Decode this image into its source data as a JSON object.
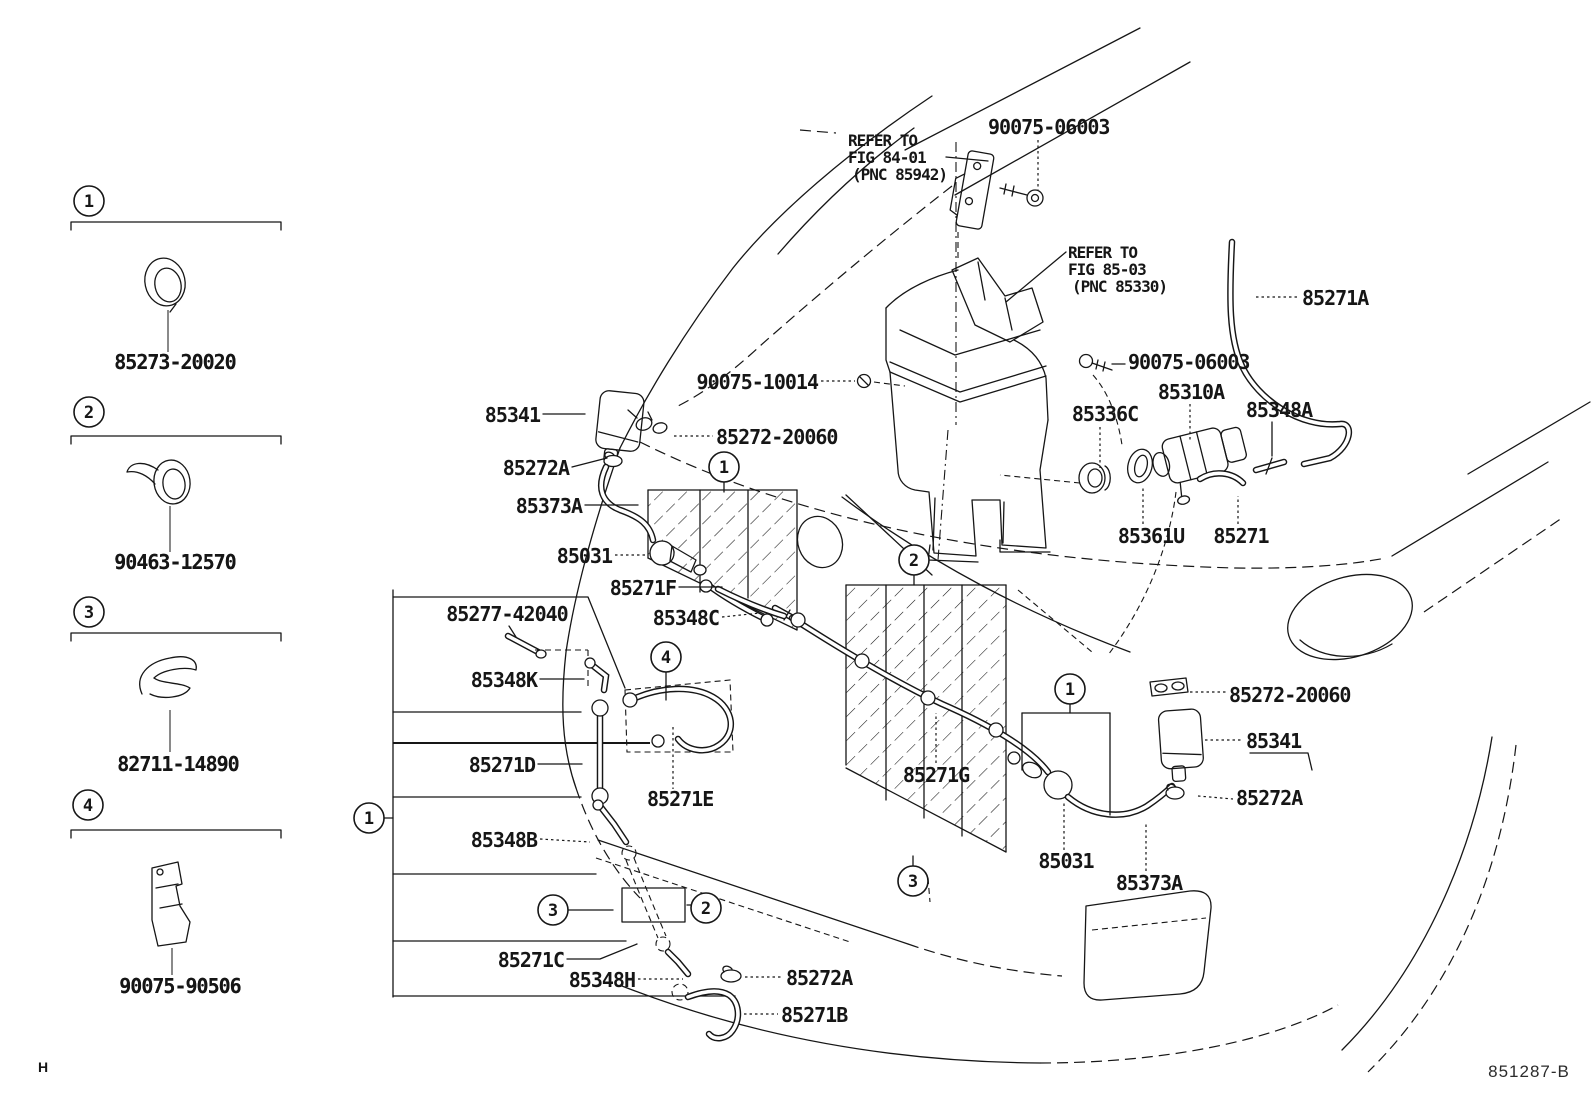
{
  "drawing": {
    "code": "851287-B",
    "corner_mark": "H"
  },
  "colors": {
    "ink": "#161616",
    "background": "#ffffff"
  },
  "legend": {
    "items": [
      {
        "num": "1",
        "part_number": "85273-20020"
      },
      {
        "num": "2",
        "part_number": "90463-12570"
      },
      {
        "num": "3",
        "part_number": "82711-14890"
      },
      {
        "num": "4",
        "part_number": "90075-90506"
      }
    ]
  },
  "reference_notes": [
    {
      "lines": [
        "REFER TO",
        "FIG 84-01",
        "(PNC 85942)"
      ],
      "x": 848,
      "y": 146
    },
    {
      "lines": [
        "REFER TO",
        "FIG 85-03",
        "(PNC 85330)"
      ],
      "x": 1068,
      "y": 258
    }
  ],
  "callouts": [
    {
      "text": "90075-06003",
      "x": 988,
      "y": 134,
      "anchor": "start"
    },
    {
      "text": "90075-10014",
      "x": 818,
      "y": 389,
      "anchor": "end"
    },
    {
      "text": "85341",
      "x": 540,
      "y": 422,
      "anchor": "end"
    },
    {
      "text": "85272-20060",
      "x": 716,
      "y": 444,
      "anchor": "start"
    },
    {
      "text": "85272A",
      "x": 569,
      "y": 475,
      "anchor": "end"
    },
    {
      "text": "85373A",
      "x": 582,
      "y": 513,
      "anchor": "end"
    },
    {
      "text": "85031",
      "x": 612,
      "y": 563,
      "anchor": "end"
    },
    {
      "text": "85271F",
      "x": 676,
      "y": 595,
      "anchor": "end"
    },
    {
      "text": "85348C",
      "x": 719,
      "y": 625,
      "anchor": "end"
    },
    {
      "text": "85277-42040",
      "x": 507,
      "y": 621,
      "anchor": "middle"
    },
    {
      "text": "85348K",
      "x": 537,
      "y": 687,
      "anchor": "end"
    },
    {
      "text": "85271D",
      "x": 535,
      "y": 772,
      "anchor": "end"
    },
    {
      "text": "85271E",
      "x": 647,
      "y": 806,
      "anchor": "start"
    },
    {
      "text": "85348B",
      "x": 537,
      "y": 847,
      "anchor": "end"
    },
    {
      "text": "85271C",
      "x": 564,
      "y": 967,
      "anchor": "end"
    },
    {
      "text": "85348H",
      "x": 635,
      "y": 987,
      "anchor": "end"
    },
    {
      "text": "85272A",
      "x": 786,
      "y": 985,
      "anchor": "start"
    },
    {
      "text": "85271B",
      "x": 781,
      "y": 1022,
      "anchor": "start"
    },
    {
      "text": "85271G",
      "x": 936,
      "y": 782,
      "anchor": "middle"
    },
    {
      "text": "85336C",
      "x": 1105,
      "y": 421,
      "anchor": "middle"
    },
    {
      "text": "90075-06003",
      "x": 1128,
      "y": 369,
      "anchor": "start"
    },
    {
      "text": "85310A",
      "x": 1191,
      "y": 399,
      "anchor": "middle"
    },
    {
      "text": "85348A",
      "x": 1279,
      "y": 417,
      "anchor": "middle"
    },
    {
      "text": "85271A",
      "x": 1302,
      "y": 305,
      "anchor": "start"
    },
    {
      "text": "85361U",
      "x": 1151,
      "y": 543,
      "anchor": "middle"
    },
    {
      "text": "85271",
      "x": 1241,
      "y": 543,
      "anchor": "middle"
    },
    {
      "text": "85272-20060",
      "x": 1229,
      "y": 702,
      "anchor": "start"
    },
    {
      "text": "85341",
      "x": 1246,
      "y": 748,
      "anchor": "start"
    },
    {
      "text": "85272A",
      "x": 1236,
      "y": 805,
      "anchor": "start"
    },
    {
      "text": "85031",
      "x": 1066,
      "y": 868,
      "anchor": "middle"
    },
    {
      "text": "85373A",
      "x": 1149,
      "y": 890,
      "anchor": "middle"
    },
    {
      "text": "85273-20020",
      "x": 175,
      "y": 369,
      "anchor": "middle"
    },
    {
      "text": "90463-12570",
      "x": 175,
      "y": 569,
      "anchor": "middle"
    },
    {
      "text": "82711-14890",
      "x": 178,
      "y": 771,
      "anchor": "middle"
    },
    {
      "text": "90075-90506",
      "x": 180,
      "y": 993,
      "anchor": "middle"
    }
  ],
  "markers": [
    {
      "n": "1",
      "x": 724,
      "y": 467
    },
    {
      "n": "2",
      "x": 914,
      "y": 560
    },
    {
      "n": "3",
      "x": 913,
      "y": 881
    },
    {
      "n": "1",
      "x": 1070,
      "y": 689
    },
    {
      "n": "4",
      "x": 666,
      "y": 657
    },
    {
      "n": "3",
      "x": 553,
      "y": 910
    },
    {
      "n": "2",
      "x": 706,
      "y": 908
    },
    {
      "n": "1",
      "x": 369,
      "y": 818
    }
  ]
}
